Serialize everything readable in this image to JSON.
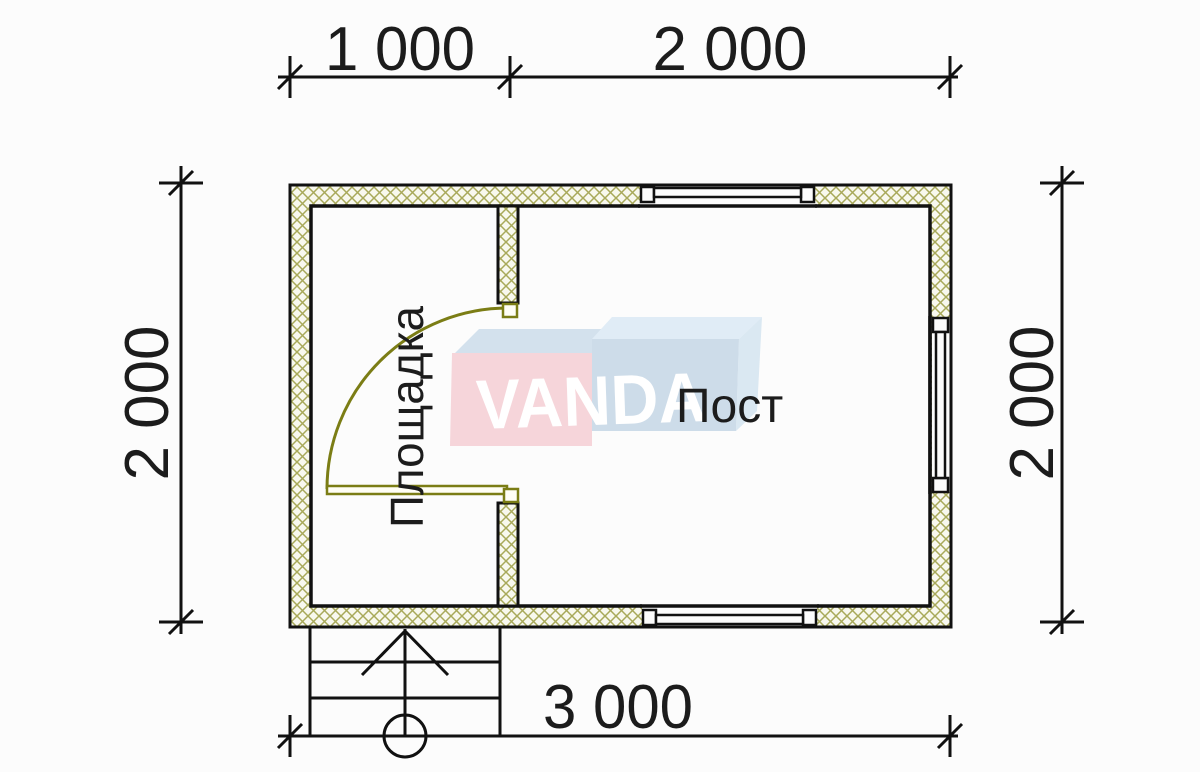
{
  "dimensions": {
    "top_left": "1 000",
    "top_right": "2 000",
    "left": "2 000",
    "right": "2 000",
    "bottom": "3 000"
  },
  "rooms": {
    "left_label": "Площадка",
    "right_label": "Пост"
  },
  "watermark": {
    "text": "VANDA"
  },
  "colors": {
    "hatch_line": "#a8a95a",
    "hatch_bg": "#f8f8ee",
    "door": "#7b7d15",
    "logo_pink": "#f6d5da",
    "logo_blue": "#cddce9",
    "logo_top_left": "#d3e1ed",
    "logo_top_right": "#e0ecf6",
    "logo_side": "#dae8f2"
  }
}
